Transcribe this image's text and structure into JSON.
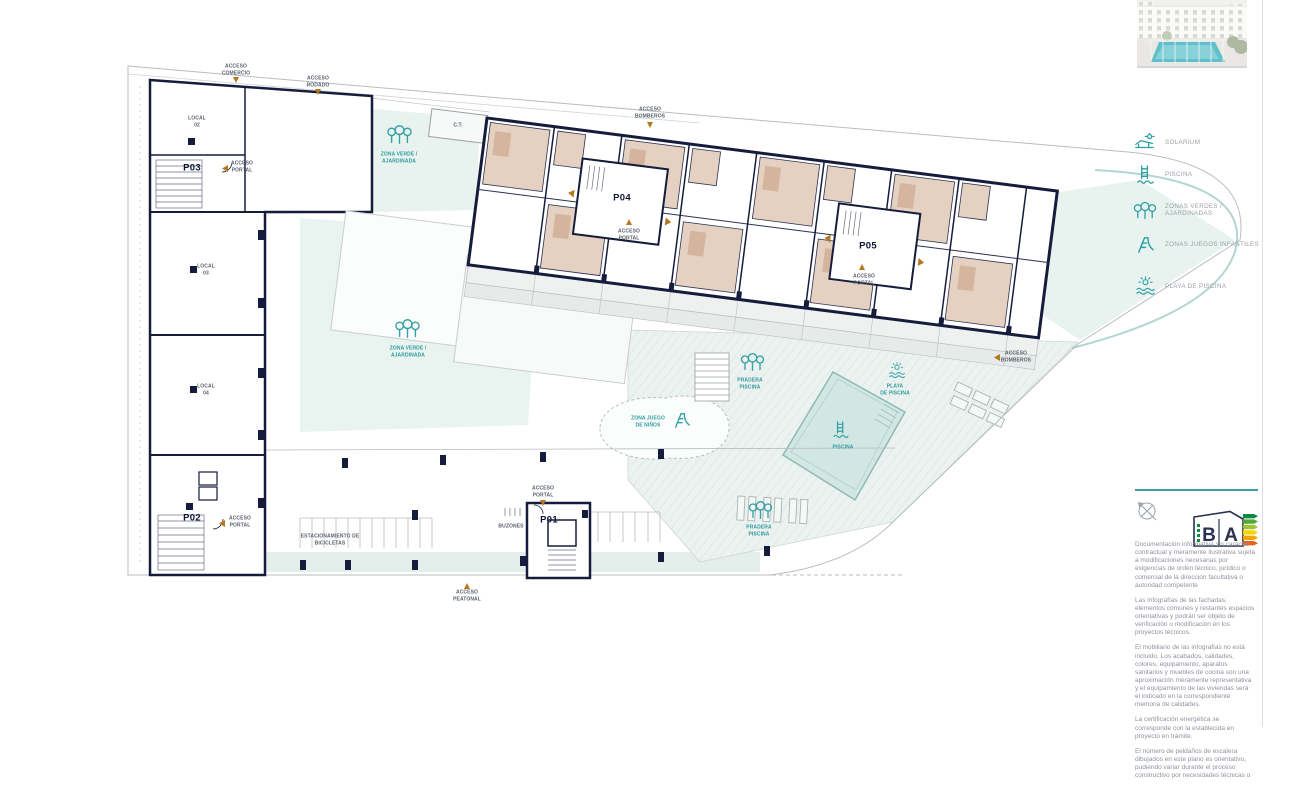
{
  "legend": {
    "items": [
      {
        "icon": "solarium-icon",
        "label": "SOLARIUM"
      },
      {
        "icon": "piscina-icon",
        "label": "PISCINA"
      },
      {
        "icon": "zonas-verdes-icon",
        "label": "ZONAS VERDES / AJARDINADAS"
      },
      {
        "icon": "juegos-infantiles-icon",
        "label": "ZONAS JUEGOS INFANTILES"
      },
      {
        "icon": "playa-piscina-icon",
        "label": "PLAYA DE PISCINA"
      }
    ]
  },
  "plan": {
    "portals": {
      "p01": "P01",
      "p02": "P02",
      "p03": "P03",
      "p04": "P04",
      "p05": "P05"
    },
    "locals": {
      "l02": "LOCAL\n02",
      "l03": "LOCAL\n03",
      "l04": "LOCAL\n04"
    },
    "labels": {
      "acceso_comercio": "ACCESO\nCOMERCIO",
      "acceso_rodado": "ACCESO\nRODADO",
      "acceso_bomberos": "ACCESO\nBOMBEROS",
      "acceso_portal": "ACCESO\nPORTAL",
      "acceso_peatonal": "ACCESO\nPEATONAL",
      "ct": "C.T.",
      "zona_verde": "ZONA VERDE /\nAJARDINADA",
      "zona_juego": "ZONA JUEGO\nDE NIÑOS",
      "pradera_piscina": "PRADERA\nPISCINA",
      "playa_piscina": "PLAYA\nDE PISCINA",
      "piscina": "PISCINA",
      "estacionamiento": "ESTACIONAMIENTO DE\nBICICLETAS",
      "buzones": "BUZONES"
    }
  },
  "energy": {
    "letter_b": "B",
    "letter_a": "A",
    "scale_colors": [
      "#0c8a42",
      "#53a83c",
      "#9bc432",
      "#f2d500",
      "#f0a500",
      "#e8641b",
      "#d3322a"
    ]
  },
  "colors": {
    "accent_teal": "#2f9ba0",
    "wall_navy": "#161c3c",
    "room_beige": "#e4d1c1",
    "arrow_orange": "#b5771f"
  },
  "disclaimer": {
    "paragraphs": {
      "p1": "Documentación informativa sin carácter contractual y meramente ilustrativa sujeta a modificaciones necesarias por exigencias de orden técnico, jurídico o comercial de la dirección facultativa o autoridad competente.",
      "p2": "Las infografías de las fachadas, elementos comunes y restantes espacios orientativas y podrán ser objeto de verificación o modificación en los proyectos técnicos.",
      "p3": "El mobiliario de las infografías no está incluido. Los acabados, calidades, colores, equipamiento, aparatos sanitarios y muebles de cocina son una aproximación meramente representativa y el equipamiento de las viviendas será el indicado en la correspondiente memoria de calidades.",
      "p4": "La certificación energética se corresponde con la establecida en proyecto en trámite.",
      "p5": "El número de peldaños de escalera dibujados en este plano es orientativo, pudiendo variar durante el proceso constructivo por necesidades técnicas o"
    }
  }
}
